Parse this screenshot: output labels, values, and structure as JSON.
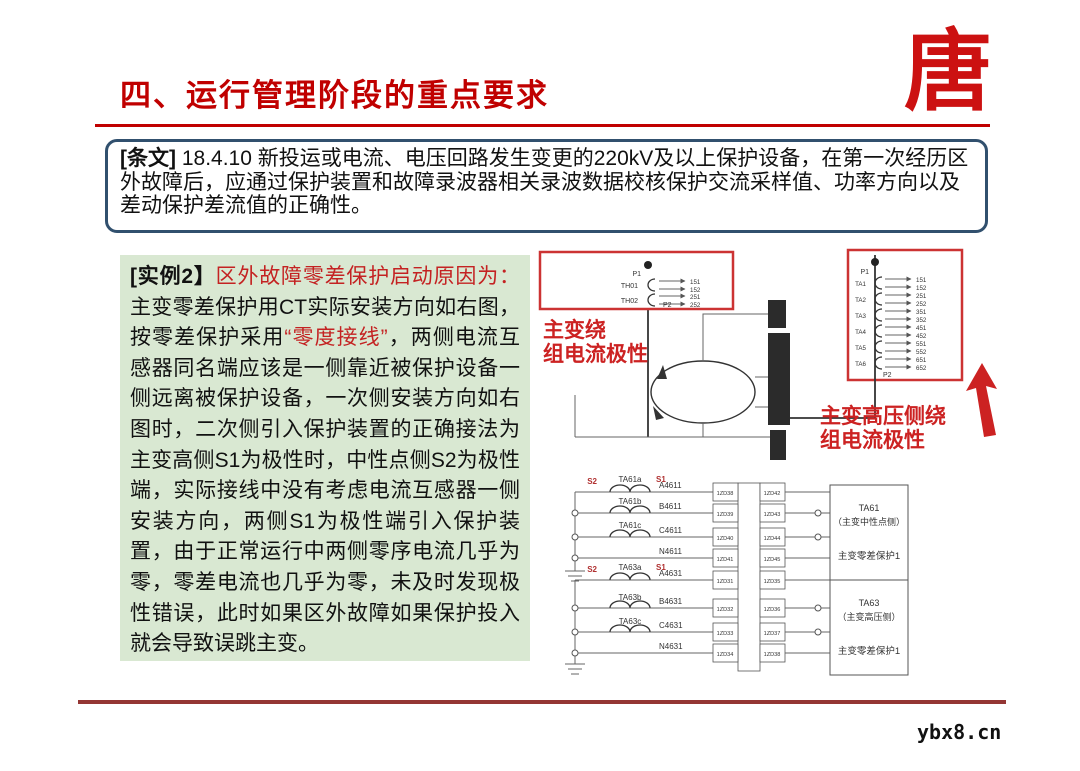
{
  "slide": {
    "title": "四、运行管理阶段的重点要求",
    "watermark": "ybx8.cn",
    "logo_char": "唐",
    "accent_red": "#c00000"
  },
  "article": {
    "label": "[条文]",
    "body": " 18.4.10 新投运或电流、电压回路发生变更的220kV及以上保护设备，在第一次经历区外故障后，应通过保护装置和故障录波器相关录波数据校核保护交流采样值、功率方向以及差动保护差流值的正确性。"
  },
  "example": {
    "label": "[实例2】",
    "red_intro": "区外故障零差保护启动原因为：",
    "body_1": "主变零差保护用CT实际安装方向如右图，按零差保护采用",
    "red_term": "“零度接线”",
    "body_2": "，两侧电流互感器同名端应该是一侧靠近被保护设备一侧远离被保护设备，一次侧安装方向如右图时，二次侧引入保护装置的正确接法为主变高侧S1为极性时，中性点侧S2为极性端，实际接线中没有考虑电流互感器一侧安装方向，两侧S1为极性端引入保护装置，由于正常运行中两侧零序电流几乎为零，零差电流也几乎为零，未及时发现极性错误，此时如果区外故障如果保护投入就会导致误跳主变。"
  },
  "diagram": {
    "label_left_1": "主变绕",
    "label_left_2": "组电流极性",
    "label_right_1": "主变高压侧绕",
    "label_right_2": "组电流极性",
    "left_box": {
      "p1": "P1",
      "p2": "P2",
      "w": [
        {
          "n": "TH01",
          "o1": "151",
          "o2": "152"
        },
        {
          "n": "TH02",
          "o1": "251",
          "o2": "252"
        }
      ]
    },
    "right_box": {
      "p1": "P1",
      "p2": "P2",
      "w": [
        {
          "n": "TA1",
          "o1": "151",
          "o2": "152"
        },
        {
          "n": "TA2",
          "o1": "251",
          "o2": "252"
        },
        {
          "n": "TA3",
          "o1": "351",
          "o2": "352"
        },
        {
          "n": "TA4",
          "o1": "451",
          "o2": "452"
        },
        {
          "n": "TA5",
          "o1": "551",
          "o2": "552"
        },
        {
          "n": "TA6",
          "o1": "651",
          "o2": "652"
        }
      ]
    },
    "ct1": {
      "s2": "S2",
      "s1": "S1",
      "rows": [
        {
          "ct": "TA61a",
          "wire": "A4611",
          "tl": "1ZD38",
          "tr": "1ZD42"
        },
        {
          "ct": "TA61b",
          "wire": "B4611",
          "tl": "1ZD39",
          "tr": "1ZD43"
        },
        {
          "ct": "TA61c",
          "wire": "C4611",
          "tl": "1ZD40",
          "tr": "1ZD44"
        },
        {
          "ct": "",
          "wire": "N4611",
          "tl": "1ZD41",
          "tr": "1ZD45"
        }
      ]
    },
    "ct2": {
      "s2": "S2",
      "s1": "S1",
      "rows": [
        {
          "ct": "TA63a",
          "wire": "A4631",
          "tl": "1ZD31",
          "tr": "1ZD35"
        },
        {
          "ct": "TA63b",
          "wire": "B4631",
          "tl": "1ZD32",
          "tr": "1ZD36"
        },
        {
          "ct": "TA63c",
          "wire": "C4631",
          "tl": "1ZD33",
          "tr": "1ZD37"
        },
        {
          "ct": "",
          "wire": "N4631",
          "tl": "1ZD34",
          "tr": "1ZD38"
        }
      ]
    },
    "info1": {
      "t": "TA61",
      "s": "（主变中性点侧）",
      "b": "主变零差保护1"
    },
    "info2": {
      "t": "TA63",
      "s": "（主变高压侧）",
      "b": "主变零差保护1"
    }
  }
}
